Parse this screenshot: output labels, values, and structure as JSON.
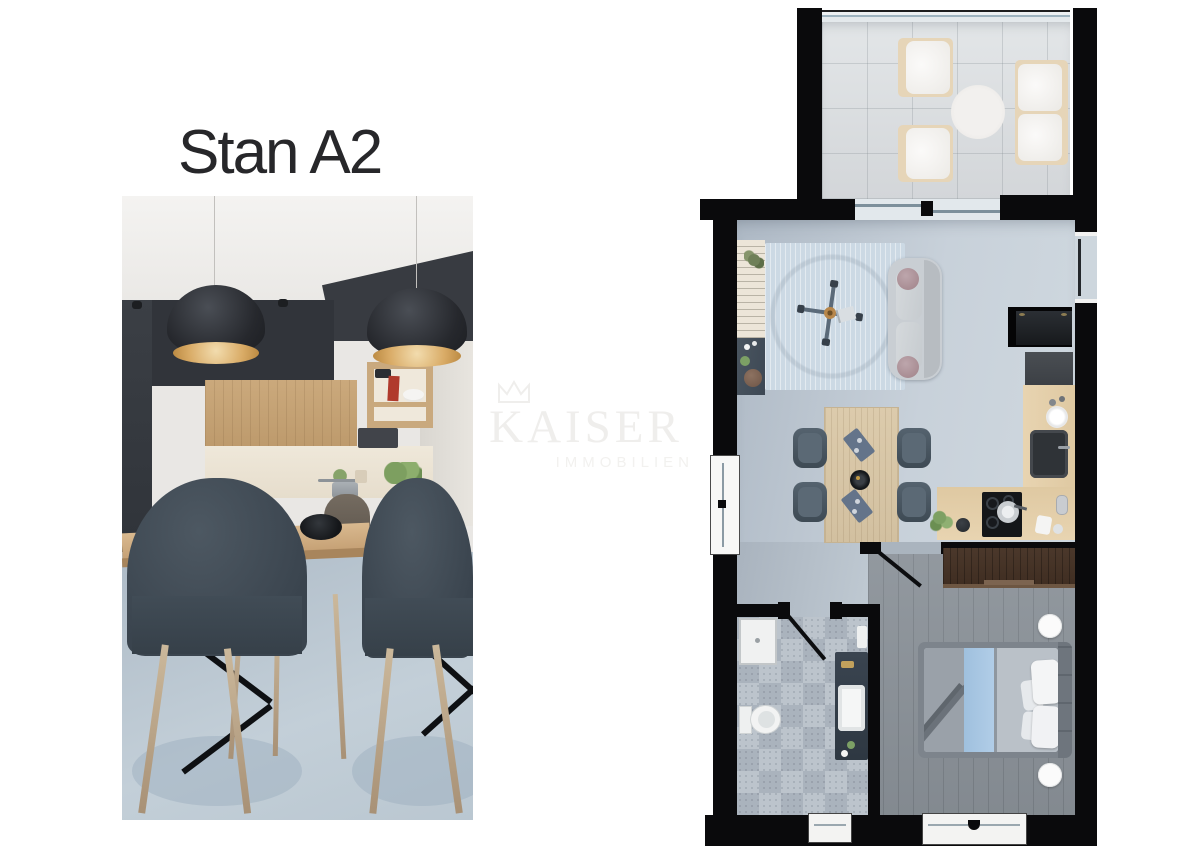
{
  "page": {
    "background": "#ffffff"
  },
  "listing": {
    "title": "Stan A2"
  },
  "watermark": {
    "brand": "KAISER",
    "tagline": "IMMOBILIEN",
    "icon": "crown-icon"
  },
  "colors": {
    "title_text": "#27272a",
    "watermark_text": "#efeeec",
    "plan_wall": "#0a0a0c",
    "terrace_floor": "#d8dbdd",
    "living_floor": "#bcc6d0",
    "area_rug": "#cfdce6",
    "bedroom_floor": "#8b9299",
    "bathroom_tile_light": "#bcc4cc",
    "bathroom_tile_dark": "#aab3bd",
    "wardrobe_wood": "#46332a",
    "kitchen_counter_wood": "#e4cfab",
    "dining_table_wood": "#d8c7a8",
    "dining_chair": "#49555f",
    "sofa_gray": "#c9ced3",
    "bed_blanket_blue": "#a9c8e4",
    "photo_dark_cabinet": "#33363c",
    "photo_wood": "#c29e72",
    "photo_floor": "#b3c0cb"
  }
}
